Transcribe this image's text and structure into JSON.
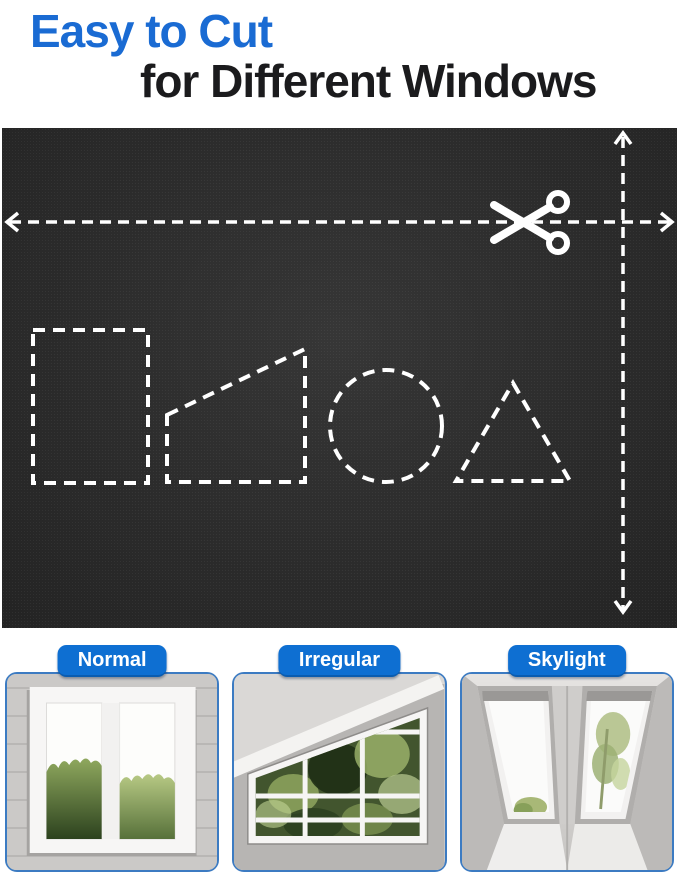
{
  "title": {
    "line1": "Easy to Cut",
    "line2": "for Different Windows"
  },
  "fabric": {
    "cut_guides": [
      "horizontal-dashed-arrow-line",
      "vertical-dashed-arrow-line"
    ],
    "icon": "scissors-icon",
    "cut_shapes": [
      "rectangle",
      "right-trapezoid",
      "circle",
      "triangle"
    ]
  },
  "cards": [
    {
      "label": "Normal",
      "image": "normal-window-photo"
    },
    {
      "label": "Irregular",
      "image": "irregular-sloped-window-photo"
    },
    {
      "label": "Skylight",
      "image": "skylight-windows-photo"
    }
  ],
  "colors": {
    "title_blue": "#1a6bd3",
    "title_dark": "#1b1b1d",
    "badge_blue": "#0e6fd2",
    "card_border_blue": "#3c7bc2",
    "fabric_black": "#1f1f1f",
    "dash_white": "#ffffff"
  }
}
